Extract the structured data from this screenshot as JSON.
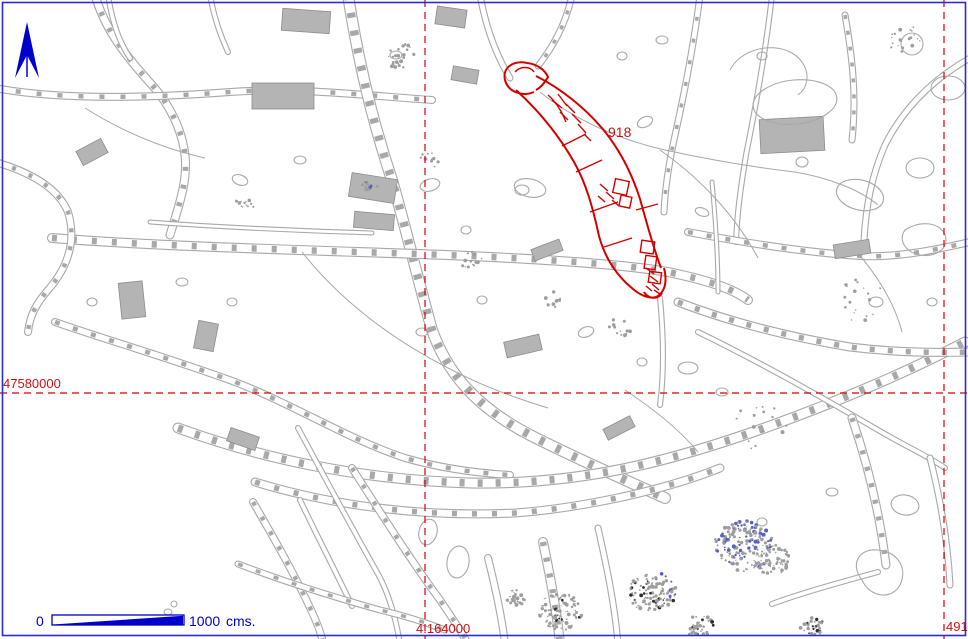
{
  "colors": {
    "background": "#ffffff",
    "linework_gray": "#a8a8a8",
    "grid_red": "#cc1111",
    "highlight_red": "#d40000",
    "annotation_blue": "#0000cd",
    "frame_blue": "#2a2ad9"
  },
  "north_arrow": {
    "icon": "north-arrow"
  },
  "grid": {
    "horizontal_label": "47580000",
    "vertical_label_center": "4.164000",
    "vertical_label_right": "491"
  },
  "highlight": {
    "label": "918"
  },
  "scale_bar": {
    "zero_label": "0",
    "distance_label": "1000",
    "unit_label": "cms."
  }
}
